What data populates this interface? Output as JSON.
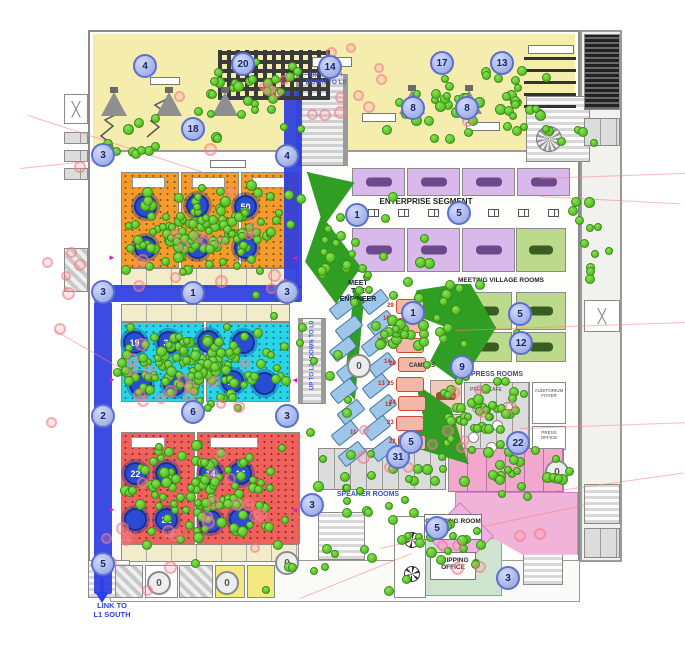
{
  "meta": {
    "description": "Event venue level floor plan with attendee density dots, numbered room markers and wayfinding circles",
    "colors": {
      "orange_room": "#f59b2b",
      "cyan_room": "#29d3e8",
      "red_room": "#f0615c",
      "purple_room": "#d9b8ec",
      "green_room": "#bcd98c",
      "yellow_zone": "#f5edae",
      "walkway_blue": "#2b3de0",
      "park_green": "#2f9e22",
      "pink_zone": "#f2b3d9",
      "waypoint_marker": "#a9b5ea",
      "room_marker_navy": "#2a4cd4",
      "green_dot": "#4cbb1e",
      "pink_dot": "#f28a94"
    }
  },
  "labels": {
    "enterprise": "ENTERPRISE SEGMENT",
    "meeting_village": "MEETING VILLAGE ROOMS",
    "press_rooms": "PRESS ROOMS",
    "press_cafe": "PRESS CAFE",
    "auditorium_foyer": "AUDITORIUM FOYER",
    "press_office": "PRESS OFFICE",
    "speaker_rooms": "SPEAKER ROOMS",
    "meet_engineer": "MEET\nTHE\nENGINEER",
    "campus": "CAMPUS",
    "catering_room": "CATERING ROOM",
    "shipping_office": "SHIPPING\nOFFICE",
    "link_l1_south": "LINK TO\nL1 SOUTH",
    "escalator_top": "UP TO L2 /\nDOWN TO L0",
    "escalator_mid": "UP TO L2 / DOWN TO L0"
  },
  "markers": {
    "waypoints": [
      {
        "n": "4",
        "x": 145,
        "y": 66
      },
      {
        "n": "20",
        "x": 243,
        "y": 64
      },
      {
        "n": "14",
        "x": 330,
        "y": 67
      },
      {
        "n": "17",
        "x": 442,
        "y": 63
      },
      {
        "n": "13",
        "x": 502,
        "y": 63
      },
      {
        "n": "8",
        "x": 413,
        "y": 108
      },
      {
        "n": "8",
        "x": 467,
        "y": 108
      },
      {
        "n": "18",
        "x": 193,
        "y": 129
      },
      {
        "n": "3",
        "x": 103,
        "y": 155
      },
      {
        "n": "4",
        "x": 287,
        "y": 156
      },
      {
        "n": "3",
        "x": 103,
        "y": 292
      },
      {
        "n": "1",
        "x": 193,
        "y": 293
      },
      {
        "n": "3",
        "x": 287,
        "y": 292
      },
      {
        "n": "2",
        "x": 103,
        "y": 416
      },
      {
        "n": "6",
        "x": 193,
        "y": 412
      },
      {
        "n": "3",
        "x": 287,
        "y": 416
      },
      {
        "n": "5",
        "x": 103,
        "y": 564
      },
      {
        "n": "1",
        "x": 357,
        "y": 215
      },
      {
        "n": "5",
        "x": 459,
        "y": 213
      },
      {
        "n": "1",
        "x": 413,
        "y": 313
      },
      {
        "n": "5",
        "x": 520,
        "y": 314
      },
      {
        "n": "12",
        "x": 521,
        "y": 343
      },
      {
        "n": "9",
        "x": 462,
        "y": 367
      },
      {
        "n": "22",
        "x": 518,
        "y": 443
      },
      {
        "n": "31",
        "x": 398,
        "y": 457
      },
      {
        "n": "5",
        "x": 411,
        "y": 442
      },
      {
        "n": "3",
        "x": 312,
        "y": 505
      },
      {
        "n": "5",
        "x": 437,
        "y": 528
      },
      {
        "n": "3",
        "x": 508,
        "y": 578
      }
    ],
    "gray_zeros": [
      {
        "n": "0",
        "x": 359,
        "y": 366
      },
      {
        "n": "0",
        "x": 557,
        "y": 472
      },
      {
        "n": "0",
        "x": 159,
        "y": 583
      },
      {
        "n": "0",
        "x": 227,
        "y": 583
      },
      {
        "n": "0",
        "x": 287,
        "y": 563
      }
    ],
    "room_circles": [
      {
        "n": "44",
        "x": 145,
        "y": 206
      },
      {
        "n": "",
        "x": 197,
        "y": 205
      },
      {
        "n": "50",
        "x": 245,
        "y": 206
      },
      {
        "n": "",
        "x": 145,
        "y": 247
      },
      {
        "n": "",
        "x": 197,
        "y": 247
      },
      {
        "n": "",
        "x": 245,
        "y": 247
      },
      {
        "n": "19",
        "x": 134,
        "y": 342
      },
      {
        "n": "33",
        "x": 168,
        "y": 342
      },
      {
        "n": "",
        "x": 208,
        "y": 341
      },
      {
        "n": "",
        "x": 243,
        "y": 342
      },
      {
        "n": "",
        "x": 140,
        "y": 384
      },
      {
        "n": "",
        "x": 174,
        "y": 384
      },
      {
        "n": "10",
        "x": 232,
        "y": 381
      },
      {
        "n": "",
        "x": 264,
        "y": 383
      },
      {
        "n": "22",
        "x": 135,
        "y": 473
      },
      {
        "n": "27",
        "x": 166,
        "y": 473
      },
      {
        "n": "14",
        "x": 210,
        "y": 473
      },
      {
        "n": "16",
        "x": 240,
        "y": 473
      },
      {
        "n": "",
        "x": 135,
        "y": 519
      },
      {
        "n": "21",
        "x": 166,
        "y": 519
      },
      {
        "n": "",
        "x": 210,
        "y": 521
      },
      {
        "n": "",
        "x": 240,
        "y": 519
      }
    ]
  },
  "rooms": [
    {
      "c": "orange",
      "x": 121,
      "y": 172,
      "w": 58,
      "h": 96
    },
    {
      "c": "orange",
      "x": 181,
      "y": 172,
      "w": 58,
      "h": 96
    },
    {
      "c": "orange",
      "x": 241,
      "y": 172,
      "w": 58,
      "h": 96
    },
    {
      "c": "beige",
      "x": 121,
      "y": 268,
      "w": 178,
      "h": 20
    },
    {
      "c": "beige",
      "x": 121,
      "y": 304,
      "w": 169,
      "h": 18
    },
    {
      "c": "cyan",
      "x": 121,
      "y": 322,
      "w": 83,
      "h": 80
    },
    {
      "c": "cyan",
      "x": 206,
      "y": 322,
      "w": 84,
      "h": 80
    },
    {
      "c": "red",
      "x": 121,
      "y": 432,
      "w": 74,
      "h": 112
    },
    {
      "c": "red",
      "x": 197,
      "y": 432,
      "w": 103,
      "h": 112
    },
    {
      "c": "beige",
      "x": 121,
      "y": 544,
      "w": 178,
      "h": 18
    },
    {
      "c": "purple",
      "x": 352,
      "y": 168,
      "w": 53,
      "h": 28
    },
    {
      "c": "purple",
      "x": 407,
      "y": 168,
      "w": 53,
      "h": 28
    },
    {
      "c": "purple",
      "x": 462,
      "y": 168,
      "w": 53,
      "h": 28
    },
    {
      "c": "purple",
      "x": 517,
      "y": 168,
      "w": 53,
      "h": 28
    },
    {
      "c": "purple",
      "x": 352,
      "y": 228,
      "w": 53,
      "h": 44
    },
    {
      "c": "purple",
      "x": 407,
      "y": 228,
      "w": 53,
      "h": 44
    },
    {
      "c": "purple",
      "x": 462,
      "y": 228,
      "w": 53,
      "h": 44
    },
    {
      "c": "green",
      "x": 516,
      "y": 228,
      "w": 50,
      "h": 44
    },
    {
      "c": "green",
      "x": 462,
      "y": 292,
      "w": 50,
      "h": 38
    },
    {
      "c": "green",
      "x": 516,
      "y": 292,
      "w": 50,
      "h": 38
    },
    {
      "c": "green",
      "x": 462,
      "y": 332,
      "w": 50,
      "h": 30
    },
    {
      "c": "green",
      "x": 516,
      "y": 332,
      "w": 50,
      "h": 30
    },
    {
      "c": "salmonroom",
      "x": 430,
      "y": 380,
      "w": 32,
      "h": 32
    },
    {
      "c": "salmonroom",
      "x": 430,
      "y": 414,
      "w": 32,
      "h": 32
    },
    {
      "c": "grayroom",
      "x": 464,
      "y": 382,
      "w": 66,
      "h": 68
    },
    {
      "c": "whiteroom",
      "x": 532,
      "y": 382,
      "w": 34,
      "h": 42
    },
    {
      "c": "whiteroom",
      "x": 532,
      "y": 426,
      "w": 34,
      "h": 24
    },
    {
      "c": "grayroom",
      "x": 318,
      "y": 448,
      "w": 128,
      "h": 42
    },
    {
      "c": "pinkroom",
      "x": 448,
      "y": 448,
      "w": 116,
      "h": 44
    },
    {
      "c": "greenpale",
      "x": 424,
      "y": 538,
      "w": 78,
      "h": 58
    },
    {
      "c": "whiteroom",
      "x": 394,
      "y": 516,
      "w": 32,
      "h": 82
    },
    {
      "c": "stairs",
      "x": 526,
      "y": 96,
      "w": 64,
      "h": 66
    },
    {
      "c": "escalator",
      "x": 296,
      "y": 74,
      "w": 52,
      "h": 92
    },
    {
      "c": "escalator",
      "x": 298,
      "y": 318,
      "w": 28,
      "h": 86
    },
    {
      "c": "stairs",
      "x": 318,
      "y": 512,
      "w": 47,
      "h": 48
    },
    {
      "c": "stairs",
      "x": 523,
      "y": 540,
      "w": 40,
      "h": 45
    },
    {
      "c": "stairs",
      "x": 88,
      "y": 560,
      "w": 42,
      "h": 38
    },
    {
      "c": "rack",
      "x": 584,
      "y": 34,
      "w": 36,
      "h": 76
    },
    {
      "c": "grayroom",
      "x": 584,
      "y": 118,
      "w": 36,
      "h": 28
    },
    {
      "c": "xroom",
      "x": 584,
      "y": 300,
      "w": 36,
      "h": 32,
      "t": "╳"
    },
    {
      "c": "stairs",
      "x": 584,
      "y": 484,
      "w": 36,
      "h": 40
    },
    {
      "c": "grayroom",
      "x": 584,
      "y": 528,
      "w": 36,
      "h": 30
    },
    {
      "c": "xroom",
      "x": 64,
      "y": 94,
      "w": 24,
      "h": 30,
      "t": "╳"
    },
    {
      "c": "grayroom",
      "x": 64,
      "y": 132,
      "w": 24,
      "h": 12
    },
    {
      "c": "grayroom",
      "x": 64,
      "y": 150,
      "w": 24,
      "h": 12
    },
    {
      "c": "grayroom",
      "x": 64,
      "y": 168,
      "w": 24,
      "h": 12
    },
    {
      "c": "hatch",
      "x": 64,
      "y": 248,
      "w": 24,
      "h": 44
    },
    {
      "c": "hatch",
      "x": 115,
      "y": 565,
      "w": 28,
      "h": 33
    },
    {
      "c": "whiteroom",
      "x": 145,
      "y": 565,
      "w": 33,
      "h": 33
    },
    {
      "c": "hatch",
      "x": 179,
      "y": 565,
      "w": 34,
      "h": 33
    },
    {
      "c": "yellowroom",
      "x": 215,
      "y": 565,
      "w": 30,
      "h": 33
    },
    {
      "c": "yellowroom",
      "x": 247,
      "y": 565,
      "w": 28,
      "h": 33
    }
  ],
  "bluepath": [
    {
      "x": 284,
      "y": 88,
      "w": 18,
      "h": 200
    },
    {
      "x": 94,
      "y": 285,
      "w": 208,
      "h": 17
    },
    {
      "x": 94,
      "y": 302,
      "w": 18,
      "h": 292
    }
  ],
  "parks": [
    {
      "x": 302,
      "y": 172,
      "w": 62,
      "h": 132,
      "clip": "polygon(8% 0, 85% 8%, 40% 38%, 95% 72%, 55% 100%, 5% 68%, 30% 34%)"
    },
    {
      "x": 344,
      "y": 288,
      "w": 20,
      "h": 112,
      "clip": "polygon(50% 0, 100% 10%, 55% 100%, 0 90%)"
    },
    {
      "x": 408,
      "y": 282,
      "w": 88,
      "h": 102,
      "clip": "polygon(10% 8%, 70% 0, 100% 45%, 60% 100%, 25% 78%, 45% 45%, 0 30%)"
    },
    {
      "x": 402,
      "y": 384,
      "w": 70,
      "h": 80,
      "clip": "polygon(20% 0, 70% 30%, 95% 100%, 0 75%, 30% 40%)"
    }
  ],
  "pinkzones": [
    {
      "x": 455,
      "y": 492,
      "w": 123,
      "h": 64,
      "clip": "polygon(0 0, 100% 0, 100% 98%, 55% 98%, 20% 60%, 0 25%)"
    }
  ],
  "decor": {
    "funnels": [
      {
        "x": 101,
        "y": 92
      },
      {
        "x": 156,
        "y": 92
      },
      {
        "x": 212,
        "y": 92
      },
      {
        "x": 399,
        "y": 90
      },
      {
        "x": 456,
        "y": 90
      }
    ],
    "labelboxes": [
      {
        "x": 312,
        "y": 57,
        "w": 40,
        "h": 10
      },
      {
        "x": 528,
        "y": 45,
        "w": 46,
        "h": 9
      },
      {
        "x": 362,
        "y": 113,
        "w": 34,
        "h": 9
      },
      {
        "x": 150,
        "y": 77,
        "w": 30,
        "h": 8
      },
      {
        "x": 466,
        "y": 122,
        "w": 34,
        "h": 9
      },
      {
        "x": 210,
        "y": 160,
        "w": 36,
        "h": 8
      }
    ],
    "enterprise_desks_y": 209,
    "enterprise_desks_x": [
      368,
      398,
      428,
      458,
      488,
      518,
      548
    ],
    "blue_desks": [
      {
        "x": 330,
        "y": 300
      },
      {
        "x": 336,
        "y": 321
      },
      {
        "x": 330,
        "y": 342
      },
      {
        "x": 337,
        "y": 363
      },
      {
        "x": 331,
        "y": 384
      },
      {
        "x": 338,
        "y": 405
      },
      {
        "x": 332,
        "y": 426
      },
      {
        "x": 339,
        "y": 447
      },
      {
        "x": 362,
        "y": 295
      },
      {
        "x": 368,
        "y": 316
      },
      {
        "x": 362,
        "y": 337
      },
      {
        "x": 369,
        "y": 358
      },
      {
        "x": 363,
        "y": 379
      },
      {
        "x": 370,
        "y": 400
      },
      {
        "x": 364,
        "y": 421
      },
      {
        "x": 371,
        "y": 442
      }
    ],
    "blue_desk_numbers": [
      {
        "n": "16",
        "x": 383,
        "y": 316
      },
      {
        "n": "15",
        "x": 377,
        "y": 338
      },
      {
        "n": "14",
        "x": 384,
        "y": 359
      },
      {
        "n": "13",
        "x": 378,
        "y": 381
      },
      {
        "n": "12",
        "x": 385,
        "y": 402
      },
      {
        "n": "11",
        "x": 350,
        "y": 430
      }
    ],
    "salmon_desks": [
      {
        "n": "29",
        "x": 396,
        "y": 299
      },
      {
        "n": "28",
        "x": 397,
        "y": 318
      },
      {
        "n": "27",
        "x": 396,
        "y": 338
      },
      {
        "n": "26",
        "x": 398,
        "y": 357
      },
      {
        "n": "25",
        "x": 396,
        "y": 377
      },
      {
        "n": "24",
        "x": 398,
        "y": 396
      },
      {
        "n": "23",
        "x": 396,
        "y": 416
      },
      {
        "n": "22",
        "x": 398,
        "y": 435
      }
    ],
    "cafe_tables": [
      {
        "x": 472,
        "y": 402
      },
      {
        "x": 492,
        "y": 420
      },
      {
        "x": 468,
        "y": 432
      },
      {
        "x": 502,
        "y": 402
      },
      {
        "x": 486,
        "y": 442
      }
    ],
    "toilets": [
      {
        "x": 404,
        "y": 532
      },
      {
        "x": 404,
        "y": 566
      }
    ],
    "spiral": {
      "x": 536,
      "y": 126
    },
    "diamond": {
      "x": 436,
      "y": 512,
      "s": 48
    },
    "magenta_arrows": [
      {
        "x": 108,
        "y": 254,
        "r": 0
      },
      {
        "x": 291,
        "y": 254,
        "r": 180
      },
      {
        "x": 108,
        "y": 376,
        "r": 0
      },
      {
        "x": 291,
        "y": 376,
        "r": 180
      },
      {
        "x": 108,
        "y": 506,
        "r": 0
      },
      {
        "x": 291,
        "y": 506,
        "r": 180
      }
    ],
    "pink_lines": [
      {
        "x": 28,
        "y": 115,
        "len": 195,
        "ang": 18
      },
      {
        "x": 20,
        "y": 168,
        "len": 90,
        "ang": -6
      },
      {
        "x": 540,
        "y": 178,
        "len": 145,
        "ang": -2
      },
      {
        "x": 540,
        "y": 196,
        "len": 140,
        "ang": 3
      },
      {
        "x": 455,
        "y": 330,
        "len": 230,
        "ang": -2
      },
      {
        "x": 520,
        "y": 428,
        "len": 165,
        "ang": -2
      },
      {
        "x": 545,
        "y": 492,
        "len": 140,
        "ang": -8
      },
      {
        "x": 380,
        "y": 548,
        "len": 210,
        "ang": -12
      },
      {
        "x": 55,
        "y": 330,
        "len": 80,
        "ang": 30
      },
      {
        "x": 300,
        "y": 598,
        "len": 120,
        "ang": -22
      }
    ]
  },
  "dots": {
    "green_clusters": [
      {
        "x": 210,
        "y": 232,
        "rx": 88,
        "ry": 48,
        "n": 115,
        "seed": 11
      },
      {
        "x": 195,
        "y": 368,
        "rx": 88,
        "ry": 46,
        "n": 115,
        "seed": 12
      },
      {
        "x": 205,
        "y": 495,
        "rx": 88,
        "ry": 58,
        "n": 105,
        "seed": 13
      },
      {
        "x": 470,
        "y": 105,
        "rx": 92,
        "ry": 46,
        "n": 46,
        "seed": 14
      },
      {
        "x": 255,
        "y": 95,
        "rx": 62,
        "ry": 46,
        "n": 30,
        "seed": 15
      },
      {
        "x": 590,
        "y": 230,
        "rx": 26,
        "ry": 92,
        "n": 12,
        "seed": 16
      },
      {
        "x": 480,
        "y": 418,
        "rx": 60,
        "ry": 52,
        "n": 46,
        "seed": 17
      },
      {
        "x": 520,
        "y": 470,
        "rx": 62,
        "ry": 30,
        "n": 24,
        "seed": 18
      },
      {
        "x": 425,
        "y": 330,
        "rx": 52,
        "ry": 62,
        "n": 30,
        "seed": 19
      },
      {
        "x": 350,
        "y": 250,
        "rx": 42,
        "ry": 62,
        "n": 20,
        "seed": 20
      },
      {
        "x": 380,
        "y": 490,
        "rx": 72,
        "ry": 42,
        "n": 20,
        "seed": 21
      },
      {
        "x": 455,
        "y": 548,
        "rx": 62,
        "ry": 36,
        "n": 20,
        "seed": 22
      },
      {
        "x": 300,
        "y": 565,
        "rx": 125,
        "ry": 32,
        "n": 12,
        "seed": 23
      },
      {
        "x": 140,
        "y": 135,
        "rx": 52,
        "ry": 26,
        "n": 12,
        "seed": 24
      },
      {
        "x": 560,
        "y": 120,
        "rx": 42,
        "ry": 32,
        "n": 10,
        "seed": 25
      },
      {
        "x": 340,
        "y": 300,
        "rx": 210,
        "ry": 210,
        "n": 42,
        "seed": 26
      }
    ],
    "pink_clusters": [
      {
        "x": 200,
        "y": 240,
        "rx": 105,
        "ry": 62,
        "n": 15,
        "seed": 31
      },
      {
        "x": 195,
        "y": 375,
        "rx": 105,
        "ry": 58,
        "n": 15,
        "seed": 32
      },
      {
        "x": 200,
        "y": 500,
        "rx": 105,
        "ry": 58,
        "n": 13,
        "seed": 33
      },
      {
        "x": 300,
        "y": 100,
        "rx": 185,
        "ry": 62,
        "n": 17,
        "seed": 34
      },
      {
        "x": 450,
        "y": 430,
        "rx": 125,
        "ry": 62,
        "n": 12,
        "seed": 35
      },
      {
        "x": 120,
        "y": 560,
        "rx": 62,
        "ry": 42,
        "n": 8,
        "seed": 36
      },
      {
        "x": 58,
        "y": 300,
        "rx": 26,
        "ry": 205,
        "n": 8,
        "seed": 37
      },
      {
        "x": 480,
        "y": 540,
        "rx": 105,
        "ry": 42,
        "n": 6,
        "seed": 38
      }
    ]
  }
}
